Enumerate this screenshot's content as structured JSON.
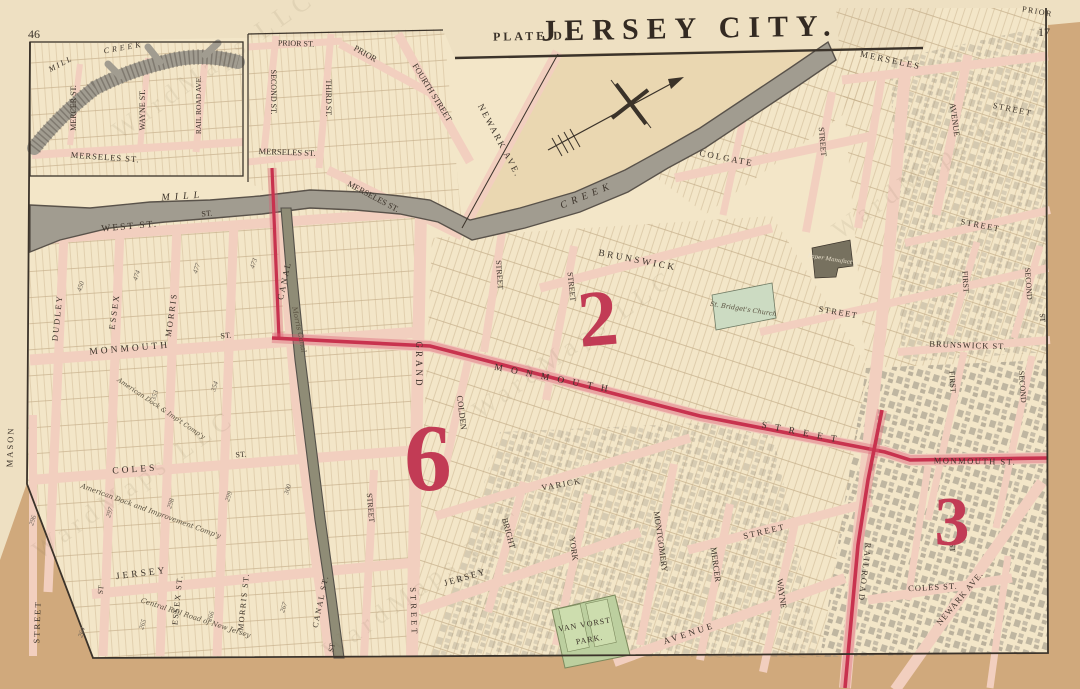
{
  "page": {
    "title": "JERSEY CITY.",
    "plate": "PLATE D.",
    "page_number_left": "46",
    "page_number_right": "17",
    "watermark": "WardMaps LLC"
  },
  "wards": [
    {
      "number": "2"
    },
    {
      "number": "6"
    },
    {
      "number": "3"
    }
  ],
  "colors": {
    "paper_margin": "#d0a97c",
    "sheet": "#eee0c2",
    "map_face": "#f3e6c8",
    "marsh": "#ead7b1",
    "street_pink": "#f2cfbf",
    "creek_gray": "#a19c90",
    "canal_olive": "#8f8c76",
    "boundary_red": "#c8324e",
    "park_green": "#bccf9f",
    "church_green": "#ccdbc2",
    "ink": "#3b332a"
  },
  "labels": [
    {
      "name": "west-st",
      "t": "WEST  ST."
    },
    {
      "name": "monmouth-st-left",
      "t": "MONMOUTH"
    },
    {
      "name": "coles-st-left",
      "t": "COLES"
    },
    {
      "name": "jersey-st-left",
      "t": "JERSEY"
    },
    {
      "name": "mason-st",
      "t": "MASON"
    },
    {
      "name": "street-left-edge",
      "t": "STREET"
    },
    {
      "name": "dudley-st",
      "t": "DUDLEY"
    },
    {
      "name": "essex-st",
      "t": "ESSEX"
    },
    {
      "name": "morris-st",
      "t": "MORRIS"
    },
    {
      "name": "canal-st-label",
      "t": "CANAL"
    },
    {
      "name": "essex-st-lower",
      "t": "ESSEX  ST."
    },
    {
      "name": "morris-st-lower",
      "t": "MORRIS  ST."
    },
    {
      "name": "canal-st-lower",
      "t": "CANAL  ST."
    },
    {
      "name": "grand-st",
      "t": "GRAND"
    },
    {
      "name": "grand-street-lower",
      "t": "STREET"
    },
    {
      "name": "morris-canal",
      "t": "Morris  Canal"
    },
    {
      "name": "mill-creek-mill",
      "t": "MILL"
    },
    {
      "name": "mill-creek-creek",
      "t": "CREEK"
    },
    {
      "name": "inset-mill",
      "t": "MILL"
    },
    {
      "name": "inset-creek",
      "t": "CREEK"
    },
    {
      "name": "inset-mercer-st",
      "t": "MERCER ST."
    },
    {
      "name": "inset-wayne-st",
      "t": "WAYNE ST."
    },
    {
      "name": "inset-railroad-ave",
      "t": "RAIL ROAD AVE."
    },
    {
      "name": "inset-merseles-st",
      "t": "MERSELES  ST."
    },
    {
      "name": "prior-st",
      "t": "PRIOR ST."
    },
    {
      "name": "prior-diag",
      "t": "PRIOR"
    },
    {
      "name": "second-st-inset",
      "t": "SECOND ST."
    },
    {
      "name": "third-st-inset",
      "t": "THIRD ST."
    },
    {
      "name": "fourth-street",
      "t": "FOURTH STREET"
    },
    {
      "name": "merseles-st-inset2",
      "t": "MERSELES ST."
    },
    {
      "name": "merseles-st-diag",
      "t": "MERSELES  ST."
    },
    {
      "name": "newark-ave-top",
      "t": "NEWARK  AVE."
    },
    {
      "name": "monmouth-street-red",
      "t": "M O N M O U T H"
    },
    {
      "name": "monmouth-street-red2",
      "t": "S T R E E T"
    },
    {
      "name": "monmouth-st-right",
      "t": "MONMOUTH  ST."
    },
    {
      "name": "colden-st",
      "t": "COLDEN"
    },
    {
      "name": "street-v1",
      "t": "STREET"
    },
    {
      "name": "street-v2",
      "t": "STREET"
    },
    {
      "name": "brunswick-street",
      "t": "BRUNSWICK"
    },
    {
      "name": "street-v3",
      "t": "STREET"
    },
    {
      "name": "colgate-street",
      "t": "COLGATE"
    },
    {
      "name": "merseles-street-ne",
      "t": "MERSELES"
    },
    {
      "name": "street-v4",
      "t": "STREET"
    },
    {
      "name": "first-avenue",
      "t": "AVENUE"
    },
    {
      "name": "street-h1",
      "t": "STREET"
    },
    {
      "name": "prior-ne",
      "t": "PRIOR"
    },
    {
      "name": "street-h2",
      "t": "STREET"
    },
    {
      "name": "street-h3",
      "t": "STREET"
    },
    {
      "name": "brunswick-st-right",
      "t": "BRUNSWICK  ST."
    },
    {
      "name": "first-st-upper",
      "t": "FIRST"
    },
    {
      "name": "second-st-upper",
      "t": "SECOND"
    },
    {
      "name": "first-st-lower",
      "t": "FIRST"
    },
    {
      "name": "second-st-lower",
      "t": "SECOND"
    },
    {
      "name": "st-bridgets-church",
      "t": "St. Bridget's Church"
    },
    {
      "name": "paper-manufactory",
      "t": "Paper Manufact'y"
    },
    {
      "name": "varick-st",
      "t": "VARICK"
    },
    {
      "name": "bright-st",
      "t": "BRIGHT"
    },
    {
      "name": "york-st",
      "t": "YORK"
    },
    {
      "name": "montgomery-st",
      "t": "MONTGOMERY"
    },
    {
      "name": "mercer-st",
      "t": "MERCER"
    },
    {
      "name": "mercer-street-h",
      "t": "STREET"
    },
    {
      "name": "wayne-st",
      "t": "WAYNE"
    },
    {
      "name": "jersey-ave",
      "t": "JERSEY"
    },
    {
      "name": "van-vorst",
      "t": "VAN  VORST"
    },
    {
      "name": "van-vorst-park",
      "t": "PARK."
    },
    {
      "name": "avenue-bottom",
      "t": "AVENUE"
    },
    {
      "name": "railroad-ave",
      "t": "RAILROAD"
    },
    {
      "name": "coles-st-right",
      "t": "COLES   ST."
    },
    {
      "name": "newark-ave-bottom",
      "t": "NEWARK  AVE."
    },
    {
      "name": "american-dock-1",
      "t": "American Dock and Improvement Comp'y"
    },
    {
      "name": "american-dock-2",
      "t": "American Dock & Imp't Comp'y"
    },
    {
      "name": "central-railroad",
      "t": "Central Rail Road of New Jersey"
    },
    {
      "name": "st-abbrev-1",
      "t": "ST."
    },
    {
      "name": "st-abbrev-2",
      "t": "ST."
    },
    {
      "name": "st-abbrev-3",
      "t": "ST."
    },
    {
      "name": "st-abbrev-4",
      "t": "ST"
    },
    {
      "name": "st-abbrev-5",
      "t": "ST"
    },
    {
      "name": "st-abbrev-6",
      "t": "ST"
    },
    {
      "name": "st-abbrev-7",
      "t": "ST"
    }
  ],
  "block_numbers": [
    {
      "t": "450"
    },
    {
      "t": "474"
    },
    {
      "t": "477"
    },
    {
      "t": "473"
    },
    {
      "t": "353"
    },
    {
      "t": "354"
    },
    {
      "t": "296"
    },
    {
      "t": "297"
    },
    {
      "t": "298"
    },
    {
      "t": "299"
    },
    {
      "t": "300"
    },
    {
      "t": "264"
    },
    {
      "t": "265"
    },
    {
      "t": "266"
    },
    {
      "t": "267"
    }
  ]
}
